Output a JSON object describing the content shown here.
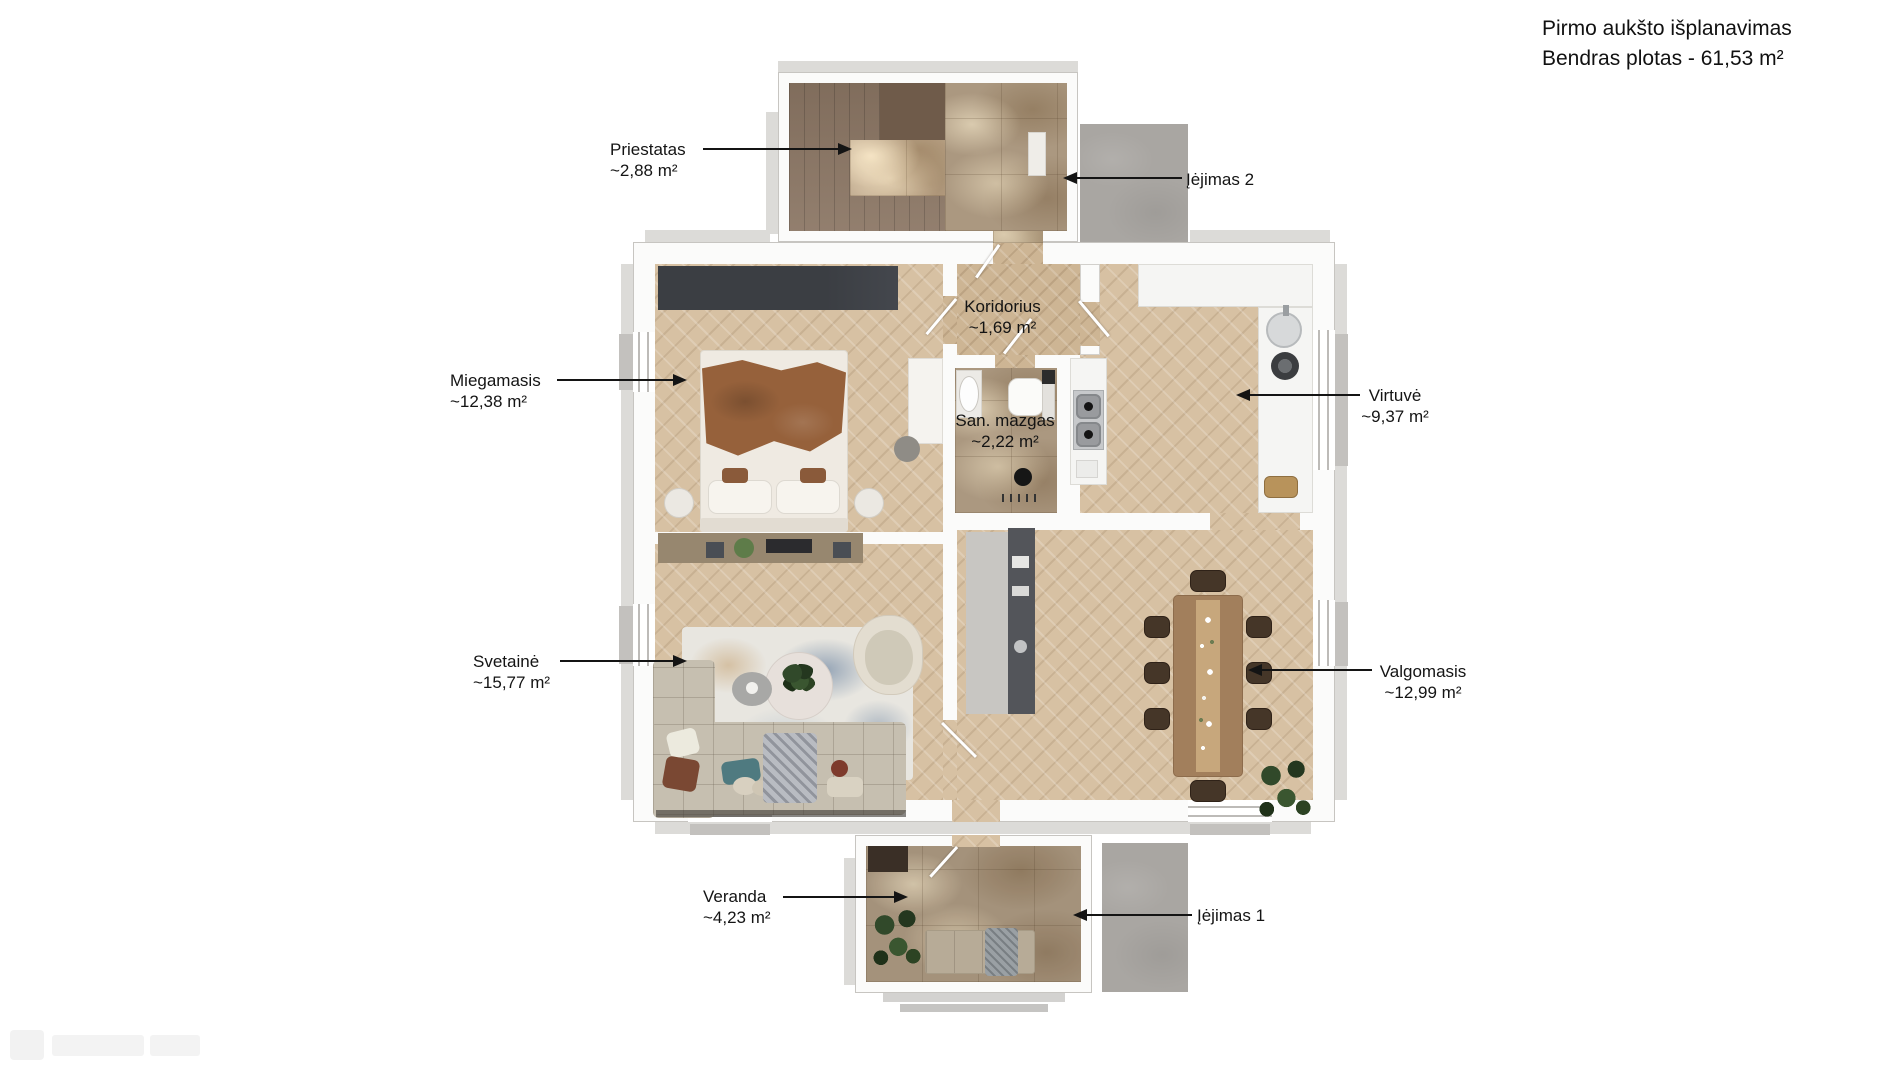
{
  "title": {
    "line1": "Pirmo aukšto išplanavimas",
    "line2": "Bendras plotas - 61,53 m²"
  },
  "labels": {
    "priestatas": {
      "name": "Priestatas",
      "area": "~2,88 m²"
    },
    "iejimas2": {
      "name": "Įėjimas 2"
    },
    "miegamasis": {
      "name": "Miegamasis",
      "area": "~12,38 m²"
    },
    "koridorius": {
      "name": "Koridorius",
      "area": "~1,69 m²"
    },
    "san_mazgas": {
      "name": "San. mazgas",
      "area": "~2,22 m²"
    },
    "virtuve": {
      "name": "Virtuvė",
      "area": "~9,37 m²"
    },
    "svetaine": {
      "name": "Svetainė",
      "area": "~15,77 m²"
    },
    "valgomasis": {
      "name": "Valgomasis",
      "area": "~12,99 m²"
    },
    "veranda": {
      "name": "Veranda",
      "area": "~4,23 m²"
    },
    "iejimas1": {
      "name": "Įėjimas 1"
    }
  },
  "colors": {
    "wall": "#fbfbfa",
    "wood_floor": "#d7c1a3",
    "tile_floor": "#ab9880",
    "concrete_pad": "#a9a6a2",
    "wardrobe": "#3b3e43",
    "label_text": "#141414"
  }
}
